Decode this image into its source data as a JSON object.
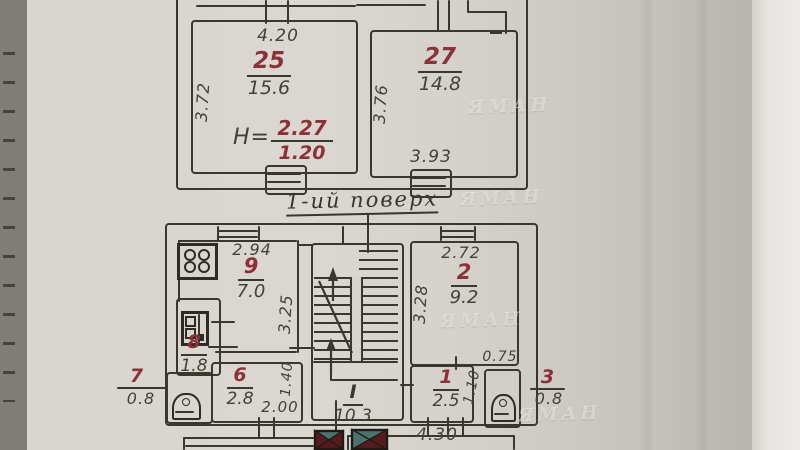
{
  "page": {
    "floor_caption": "1-ий поверх",
    "watermark": "ЯМАН"
  },
  "colors": {
    "paper": "#d7d4cd",
    "ink": "#3a372f",
    "red": "#8d3038",
    "teal": "#4a736e",
    "dark_red": "#591a1e"
  },
  "icons": {
    "stove": "stove-icon",
    "boiler": "boiler-icon",
    "toilet": "toilet-icon",
    "chimney": "chimney-flue-icon",
    "stairs": "staircase-with-direction-arrow"
  },
  "upper_plan": {
    "room25": {
      "number": "25",
      "area": "15.6",
      "dim_top": "4.20",
      "dim_left": "3.72",
      "height_label": "H=",
      "height_top": "2.27",
      "height_bottom": "1.20"
    },
    "room27": {
      "number": "27",
      "area": "14.8",
      "dim_left": "3.76",
      "dim_bottom": "3.93"
    }
  },
  "lower_plan": {
    "room9": {
      "number": "9",
      "area": "7.0",
      "dim_top": "2.94",
      "dim_right": "3.25"
    },
    "room8": {
      "number": "8",
      "area": "1.8"
    },
    "room6": {
      "number": "6",
      "area": "2.8",
      "dim_right": "1.40",
      "dim_bottom": "2.00"
    },
    "stair_hall": {
      "number": "I",
      "area": "10.3"
    },
    "room2": {
      "number": "2",
      "area": "9.2",
      "dim_top": "2.72",
      "dim_left": "3.28"
    },
    "room1": {
      "number": "1",
      "area": "2.5",
      "dim_right": "1.10",
      "dim_shaft": "0.75"
    },
    "porch_left": {
      "number": "7",
      "area": "0.8"
    },
    "porch_right": {
      "number": "3",
      "area": "0.8"
    },
    "dim_bottom": "4.30"
  }
}
